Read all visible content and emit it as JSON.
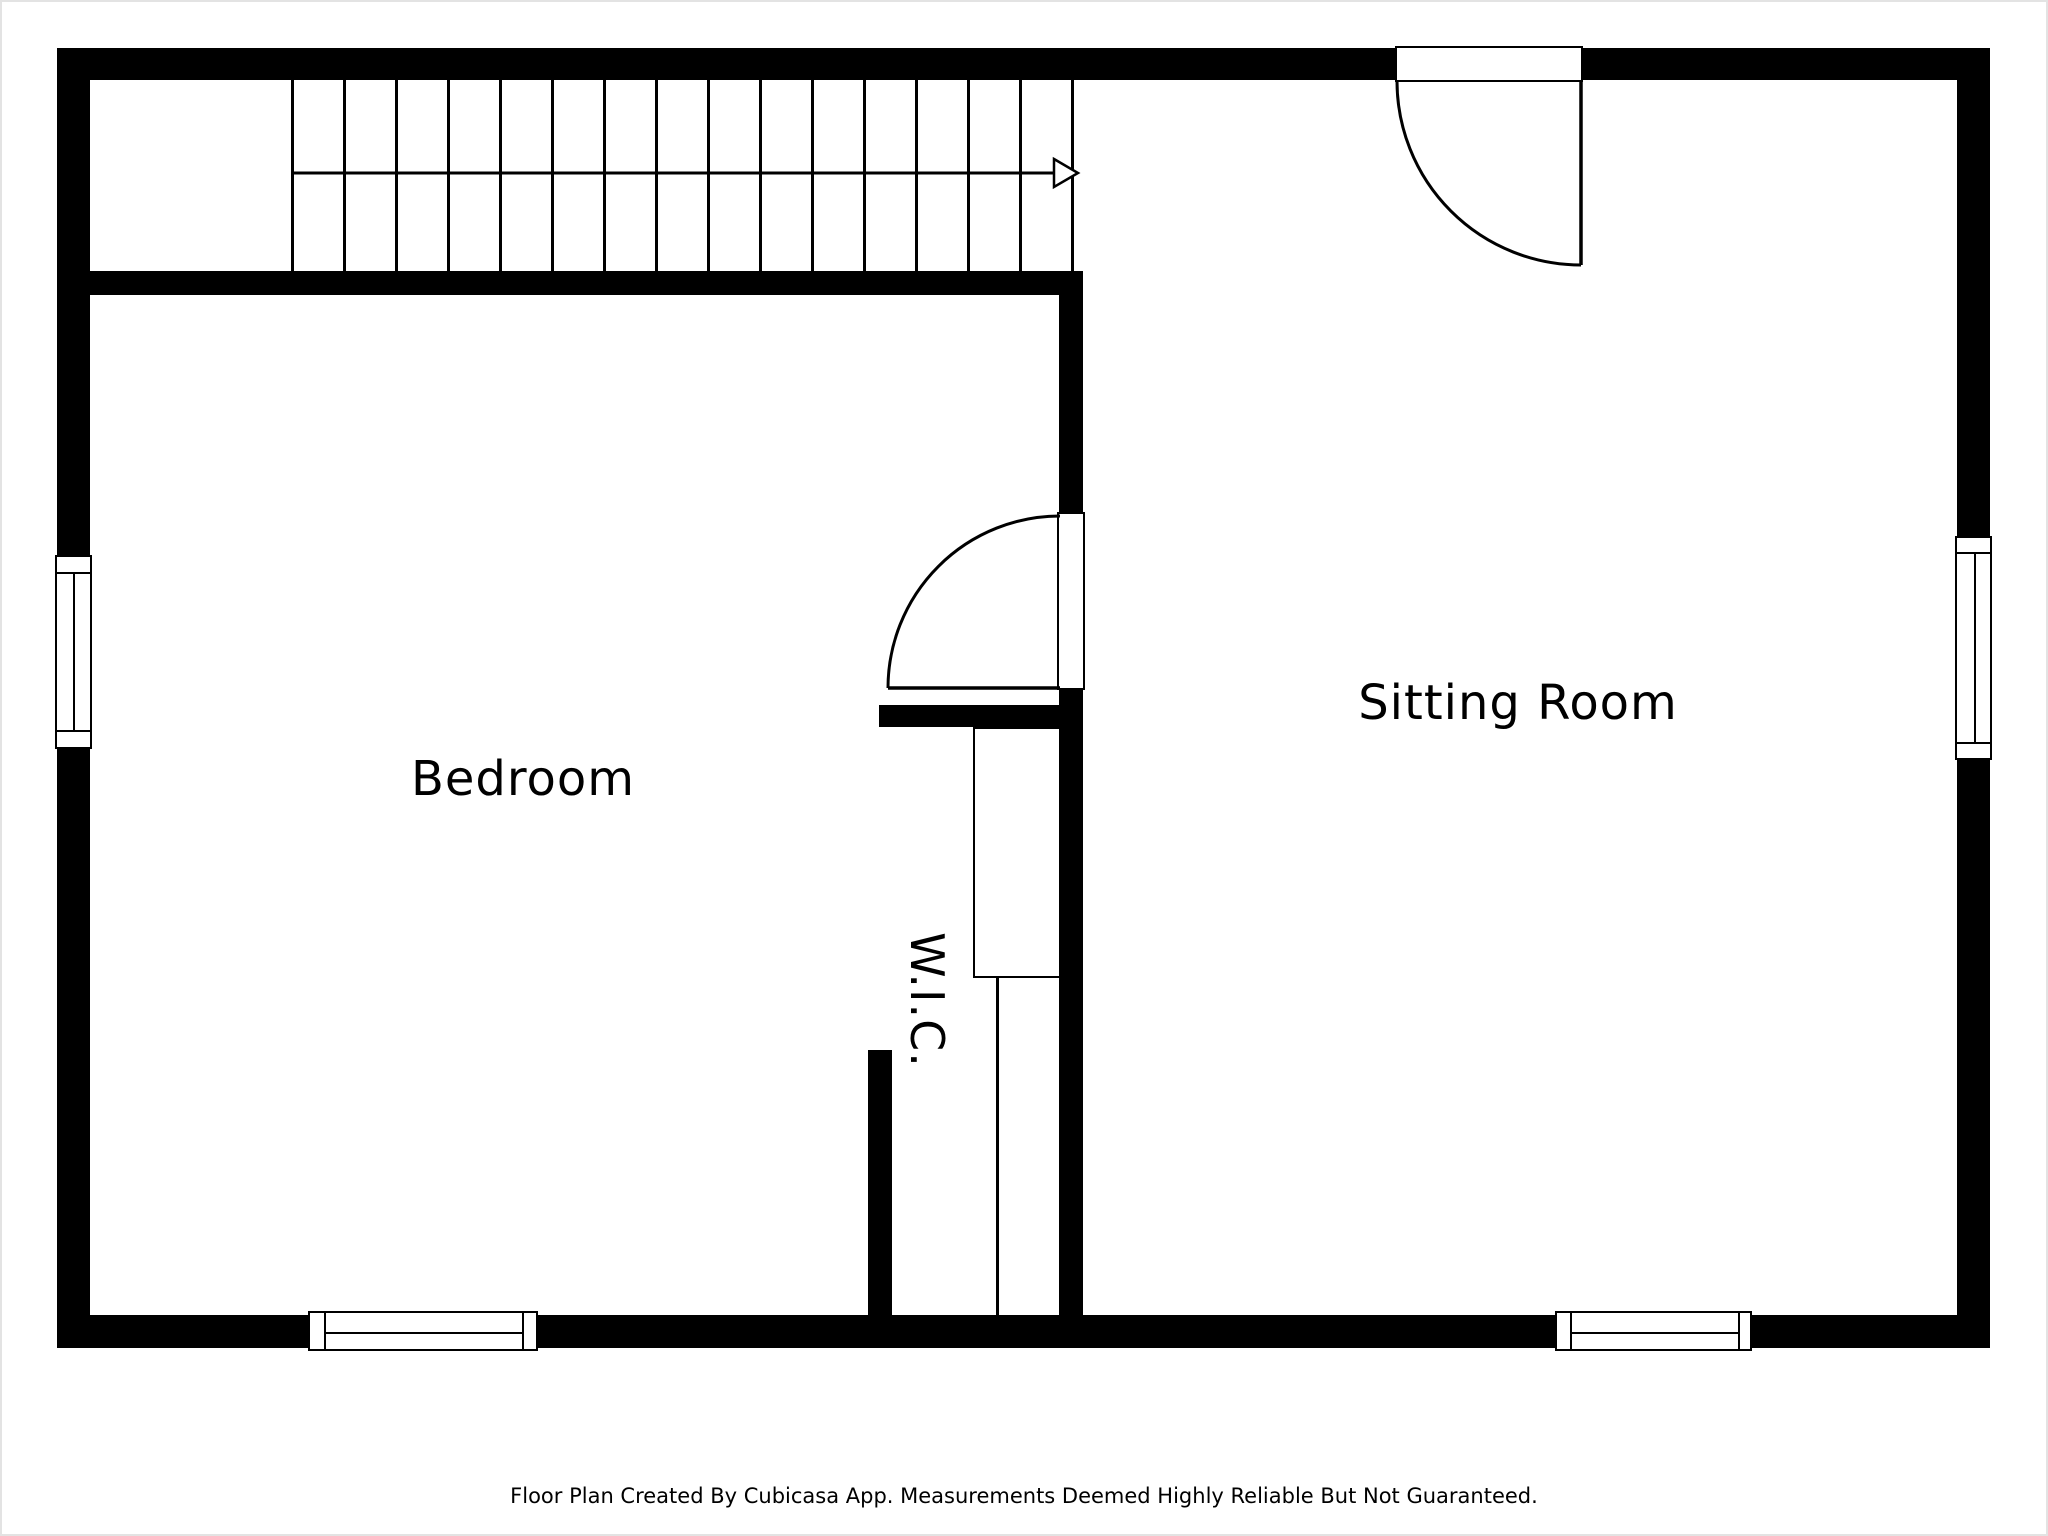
{
  "footer": {
    "text": "Floor Plan Created By Cubicasa App. Measurements Deemed Highly Reliable But Not Guaranteed."
  },
  "rooms": {
    "bedroom": {
      "label": "Bedroom"
    },
    "sitting_room": {
      "label": "Sitting Room"
    },
    "wic": {
      "label": "W.I.C."
    }
  },
  "stairs": {
    "tread_count": 16,
    "direction": "right",
    "symbol": "straight-run-staircase-with-direction-arrow"
  },
  "symbols": {
    "doors": [
      {
        "name": "sitting-room-entry-door",
        "type": "single-swing",
        "wall": "top"
      },
      {
        "name": "bedroom-to-sitting-room-door",
        "type": "single-swing",
        "wall": "middle"
      }
    ],
    "windows": [
      {
        "name": "bedroom-left-window",
        "wall": "left"
      },
      {
        "name": "bedroom-bottom-window",
        "wall": "bottom"
      },
      {
        "name": "sitting-room-right-window",
        "wall": "right"
      },
      {
        "name": "sitting-room-bottom-window",
        "wall": "bottom"
      }
    ]
  },
  "colors": {
    "wall": "#000000",
    "floor": "#ffffff",
    "text": "#000000",
    "page_border": "#e3e3e3"
  }
}
